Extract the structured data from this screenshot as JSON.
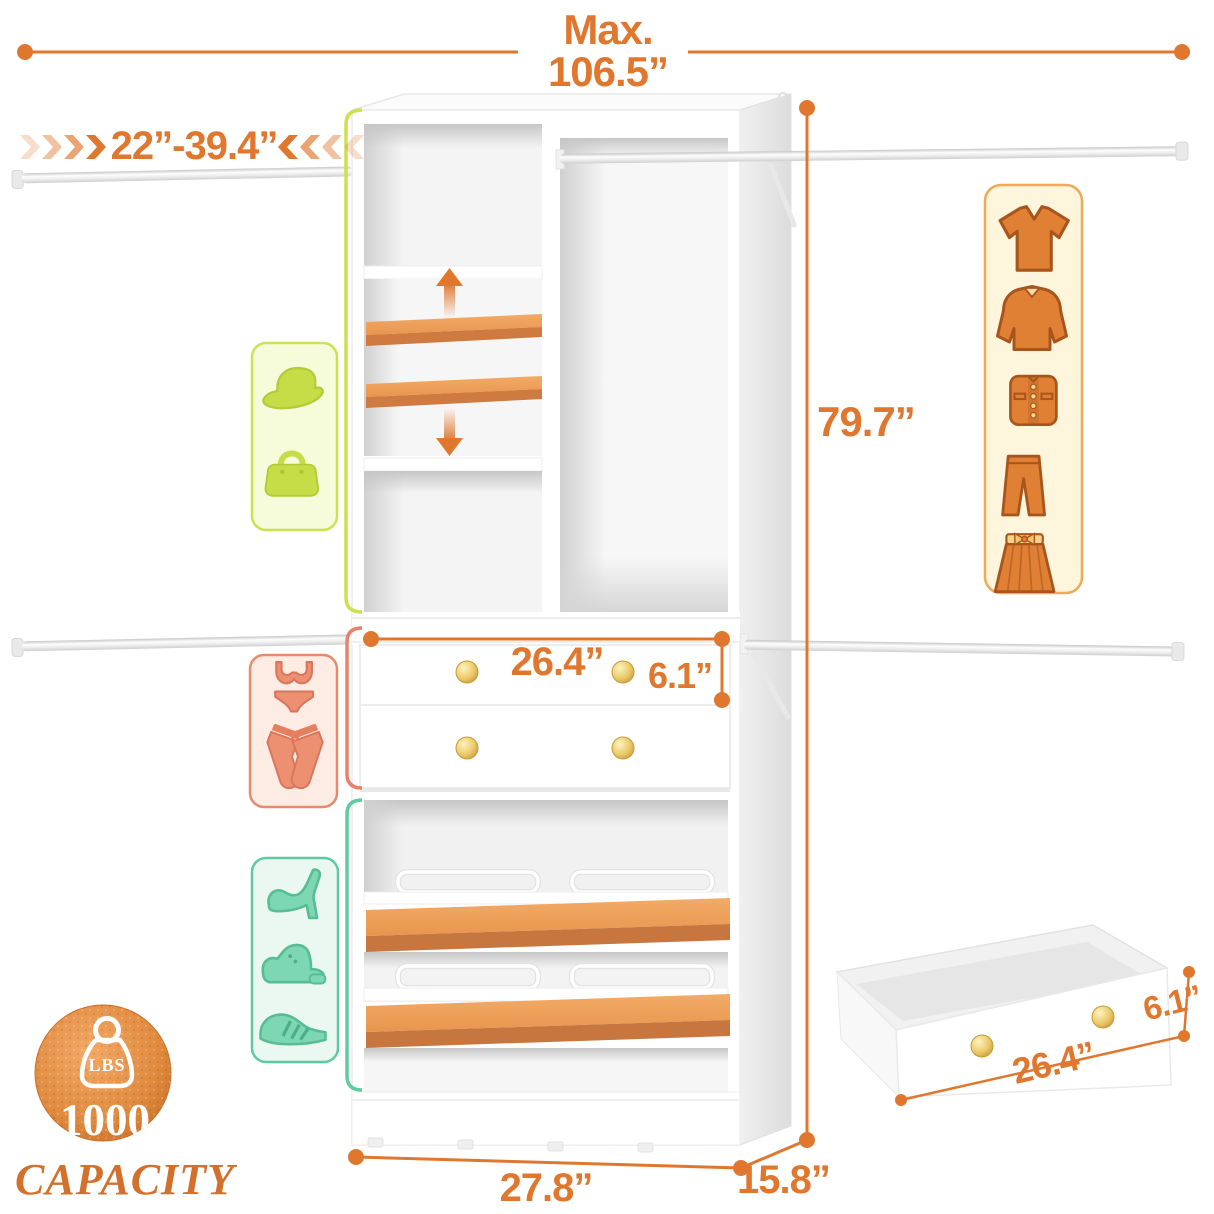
{
  "colors": {
    "accent": "#E0772E",
    "shelf_orange": "#EFA55F",
    "knob_gold": "#E3B34C",
    "green_icons": "#C6DD47",
    "salmon_icons": "#ED9071",
    "teal_icons": "#7CD7B2",
    "cream_panel": "#FDF5DC",
    "badge_orange": "#D8813B"
  },
  "dimensions": {
    "max_label": "Max.",
    "max_width": "106.5”",
    "rod_length_range": "22”-39.4”",
    "unit_height": "79.7”",
    "drawer_width": "26.4”",
    "drawer_height": "6.1”",
    "unit_width": "27.8”",
    "unit_depth": "15.8”",
    "detail_drawer_height": "6.1”",
    "detail_drawer_width": "26.4”"
  },
  "capacity_badge": {
    "unit": "LBS",
    "value": "1000",
    "label": "CAPACITY"
  },
  "icons": {
    "clothing_panel": [
      "t-shirt-icon",
      "blouse-icon",
      "jacket-icon",
      "pants-icon",
      "skirt-icon"
    ],
    "accessory_panel": [
      "sun-hat-icon",
      "handbag-icon"
    ],
    "underwear_panel": [
      "lingerie-icon",
      "crossed-socks-icon"
    ],
    "shoe_panel": [
      "high-heel-icon",
      "leather-shoe-icon",
      "sneaker-icon"
    ],
    "badge": [
      "weight-icon"
    ],
    "misc": [
      "shelf-up-arrow-icon",
      "shelf-down-arrow-icon",
      "extend-chevrons-icon"
    ]
  }
}
